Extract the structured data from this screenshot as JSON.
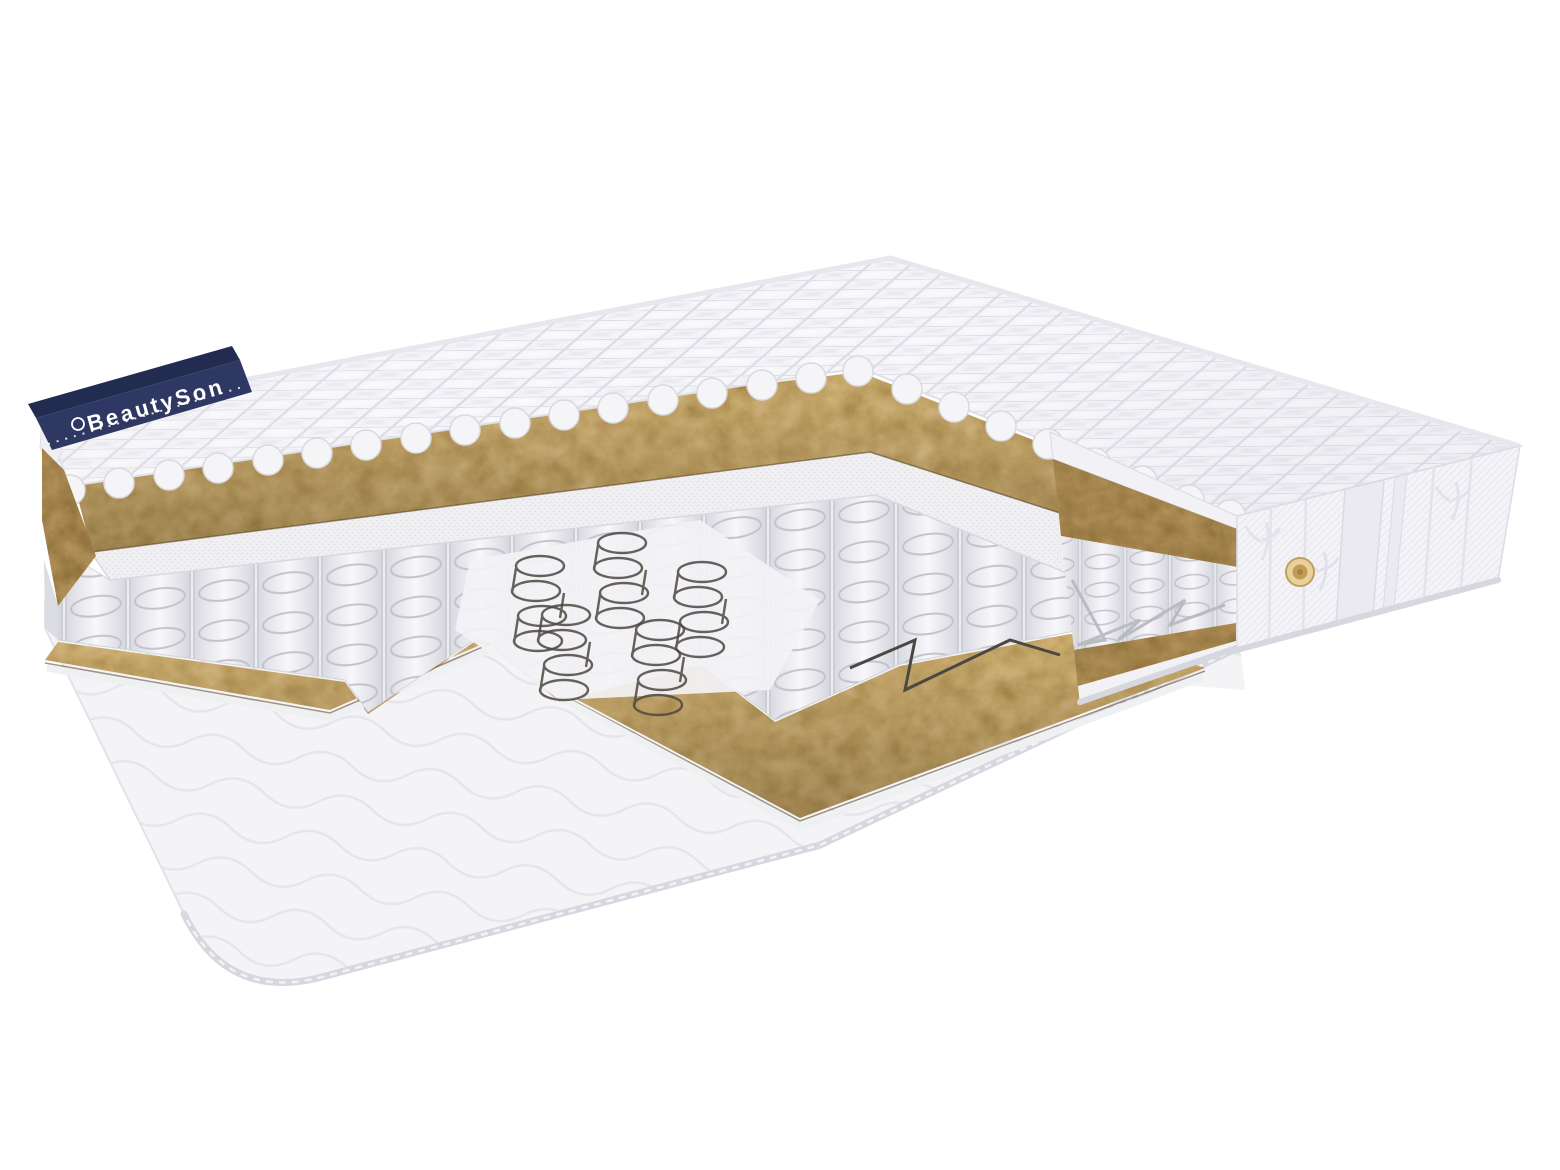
{
  "image": {
    "type": "product-photo",
    "subject": "mattress-cutaway-render",
    "description": "3D cutaway render of a double-sided pocket-spring mattress on a white background. Stepped cut reveals internal layers.",
    "background": "#ffffff"
  },
  "brand": {
    "label": "BeautySon",
    "tag_color": "#2e3862",
    "tag_fold_color": "#222b50",
    "text_color": "#ffffff"
  },
  "layers": [
    "quilted top cover",
    "coconut coir layer (top)",
    "spunbond felt pad",
    "pocket spring block",
    "open steel coils (centre zone)",
    "coconut coir layer (bottom)",
    "quilted bottom cover"
  ],
  "side_panel": {
    "decor": "embossed floral knit with vertical satin stripe",
    "air_vent": "gold air vent"
  },
  "palette": {
    "fabric_white": "#f6f6f9",
    "fabric_line": "#dfdfe7",
    "coir_mid": "#7a5526",
    "coir_dark": "#53380f",
    "gold_vent": "#d9ba79",
    "gold_vent_core": "#c29b55",
    "wire": "#4d4742",
    "piping": "#d7d7df",
    "navy": "#2e3862"
  }
}
